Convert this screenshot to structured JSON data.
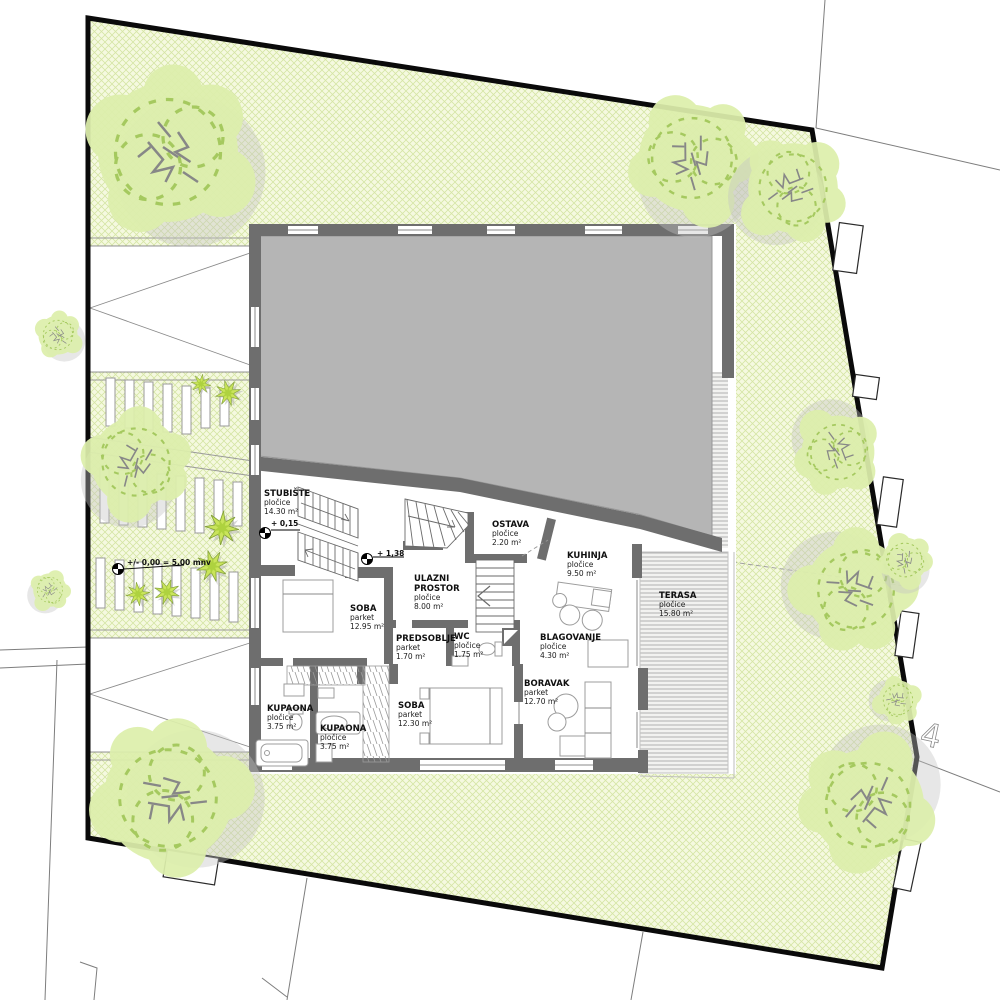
{
  "drawing": {
    "kind": "ground-floor site plan",
    "colors": {
      "site_green": "#f5f9e0",
      "hatch_green": "#cfe29b",
      "tree_green": "#ddefac",
      "bush_green": "#c9e45b",
      "roof_gray": "#b5b5b5",
      "wall_gray": "#6e6e6e",
      "boundary_black": "#0a0a0a"
    }
  },
  "site": {
    "level_note": "+/- 0,00 = 5,00 mnv",
    "parcel_mark": "4"
  },
  "levels": {
    "stair": "+ 0,15",
    "entry": "+ 1,38"
  },
  "rooms": {
    "stubiste": {
      "name": "STUBIŠTE",
      "finish": "pločice",
      "area": "14.30 m²"
    },
    "ostava": {
      "name": "OSTAVA",
      "finish": "pločice",
      "area": "2.20 m²"
    },
    "kuhinja": {
      "name": "KUHINJA",
      "finish": "pločice",
      "area": "9.50 m²"
    },
    "terasa": {
      "name": "TERASA",
      "finish": "pločice",
      "area": "15.80 m²"
    },
    "ulazni": {
      "name_lines": [
        "ULAZNI",
        "PROSTOR"
      ],
      "finish": "pločice",
      "area": "8.00 m²"
    },
    "soba1": {
      "name": "SOBA",
      "finish": "parket",
      "area": "12.95 m²"
    },
    "predsoblje": {
      "name": "PREDSOBLJE",
      "finish": "parket",
      "area": "1.70 m²"
    },
    "wc": {
      "name": "WC",
      "finish": "pločice",
      "area": "1.75 m²"
    },
    "blagovanje": {
      "name": "BLAGOVANJE",
      "finish": "pločice",
      "area": "4.30 m²"
    },
    "boravak": {
      "name": "BORAVAK",
      "finish": "parket",
      "area": "12.70 m²"
    },
    "soba2": {
      "name": "SOBA",
      "finish": "parket",
      "area": "12.30 m²"
    },
    "kupaona1": {
      "name": "KUPAONA",
      "finish": "pločice",
      "area": "3.75 m²"
    },
    "kupaona2": {
      "name": "KUPAONA",
      "finish": "pločice",
      "area": "3.75 m²"
    }
  }
}
